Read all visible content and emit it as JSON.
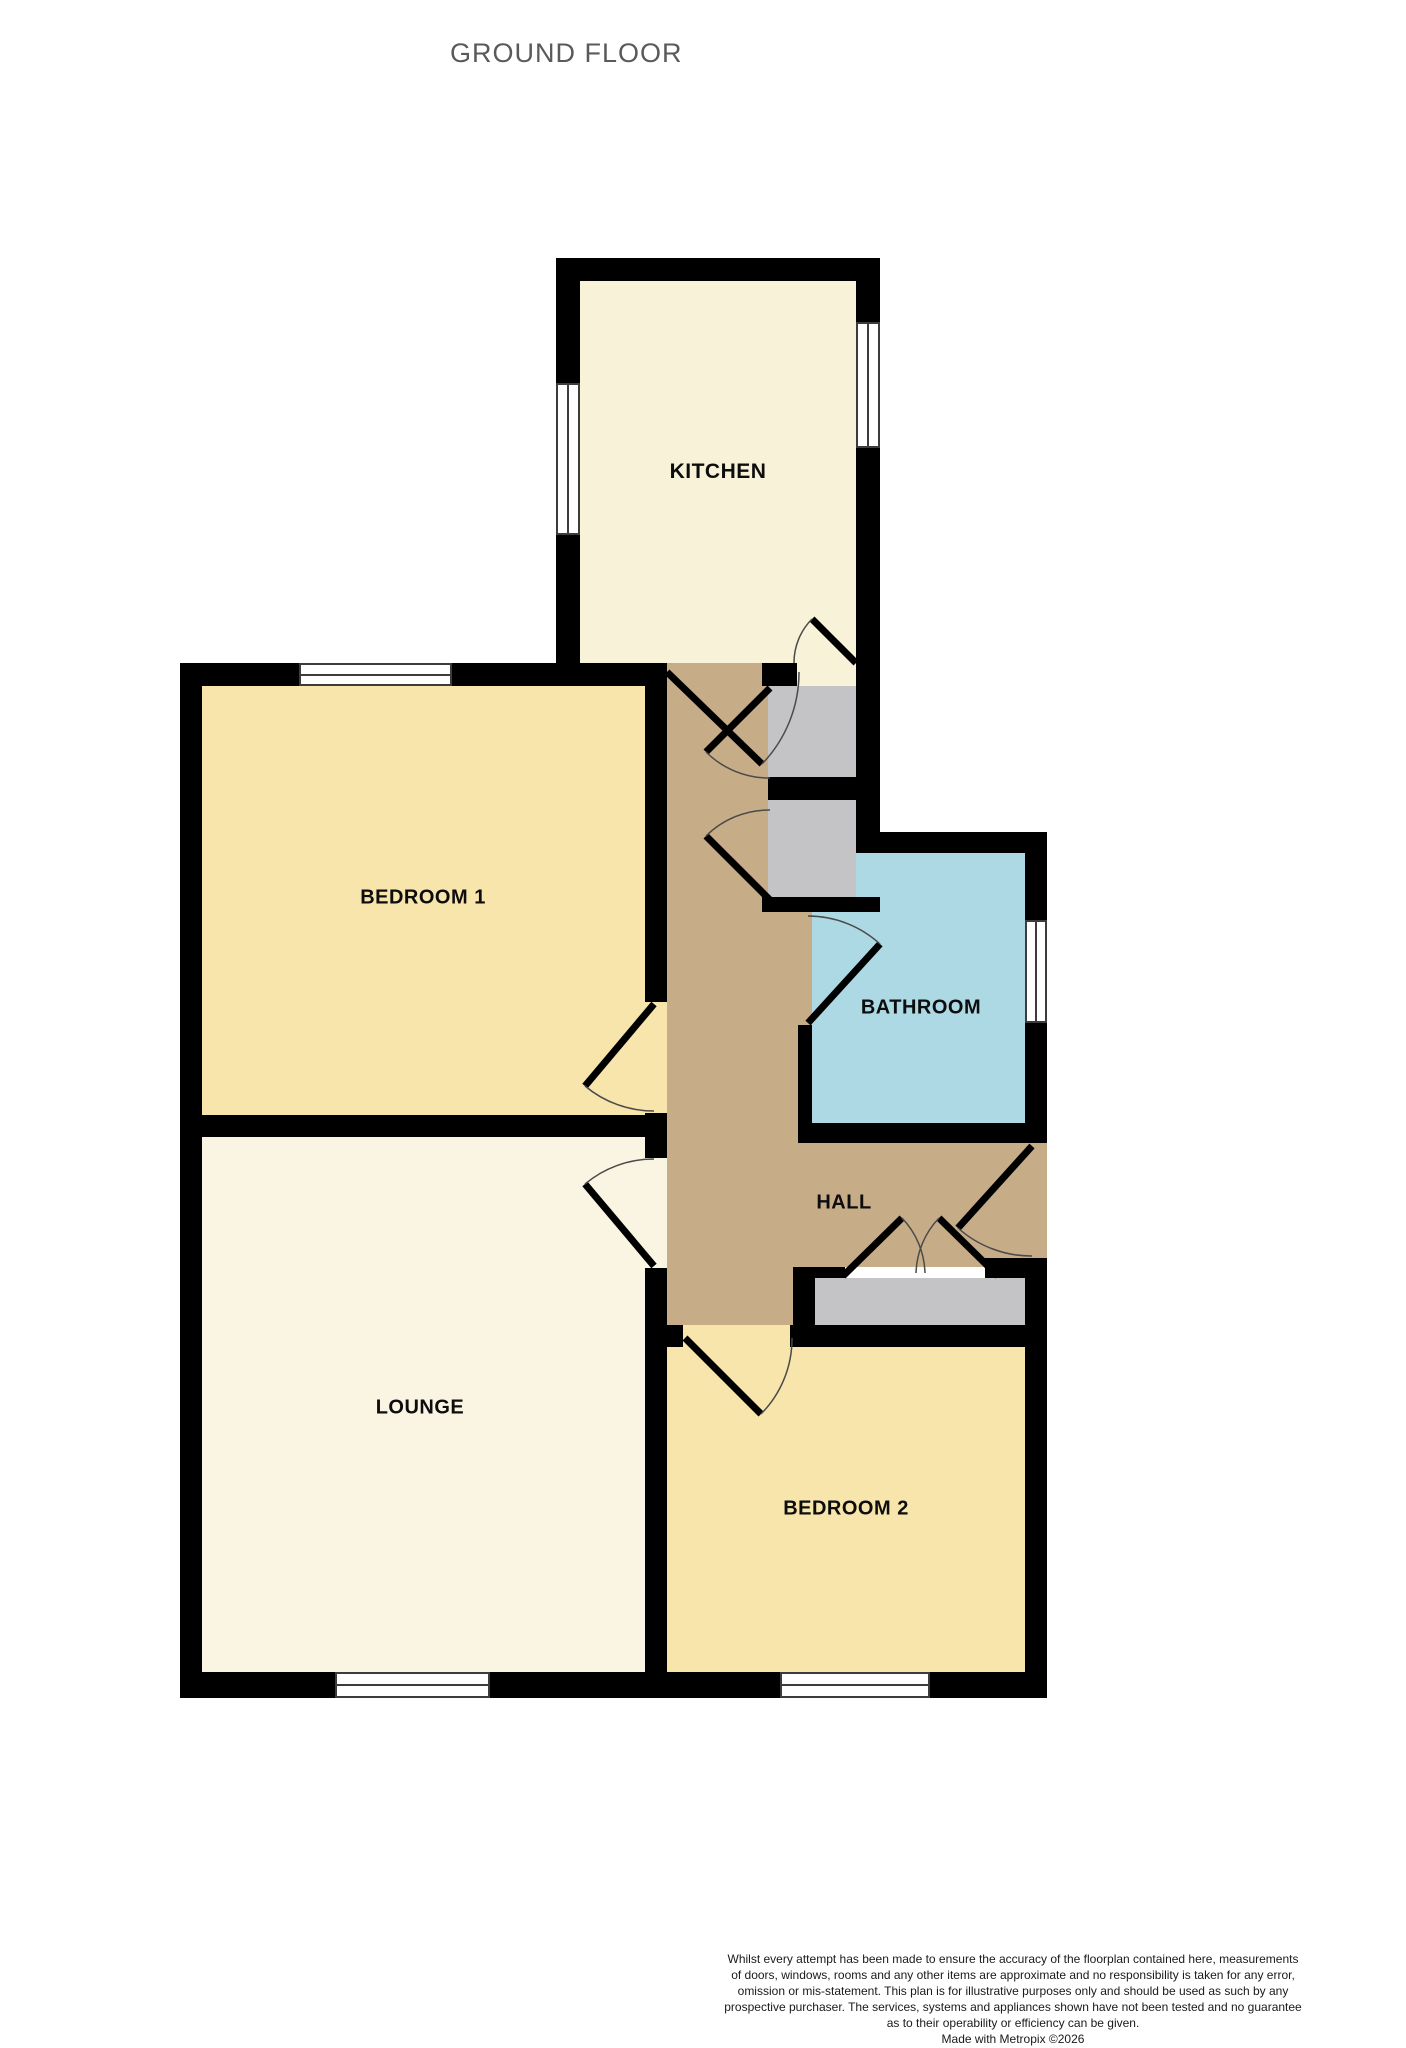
{
  "page": {
    "title": "GROUND FLOOR"
  },
  "rooms": {
    "kitchen": {
      "label": "KITCHEN"
    },
    "bedroom1": {
      "label": "BEDROOM 1"
    },
    "bathroom": {
      "label": "BATHROOM"
    },
    "hall": {
      "label": "HALL"
    },
    "lounge": {
      "label": "LOUNGE"
    },
    "bedroom2": {
      "label": "BEDROOM 2"
    }
  },
  "colors": {
    "kitchen": "#F7F2D8",
    "lounge": "#F9F5E2",
    "bedroom": "#F7E5AC",
    "hall": "#C7AC88",
    "bathroom": "#ADD9E5",
    "storage": "#C4C4C7",
    "wall": "#000000",
    "title_text": "#5A5A5A"
  },
  "disclaimer": {
    "lines": [
      "Whilst every attempt has been made to ensure the accuracy of the floorplan contained here, measurements",
      "of doors, windows, rooms and any other items are approximate and no responsibility is taken for any error,",
      "omission or mis-statement. This plan is for illustrative purposes only and should be used as such by any",
      "prospective purchaser. The services, systems and appliances shown have not been tested and no guarantee",
      "as to their operability or efficiency can be given."
    ],
    "credit": "Made with Metropix ©2026"
  }
}
